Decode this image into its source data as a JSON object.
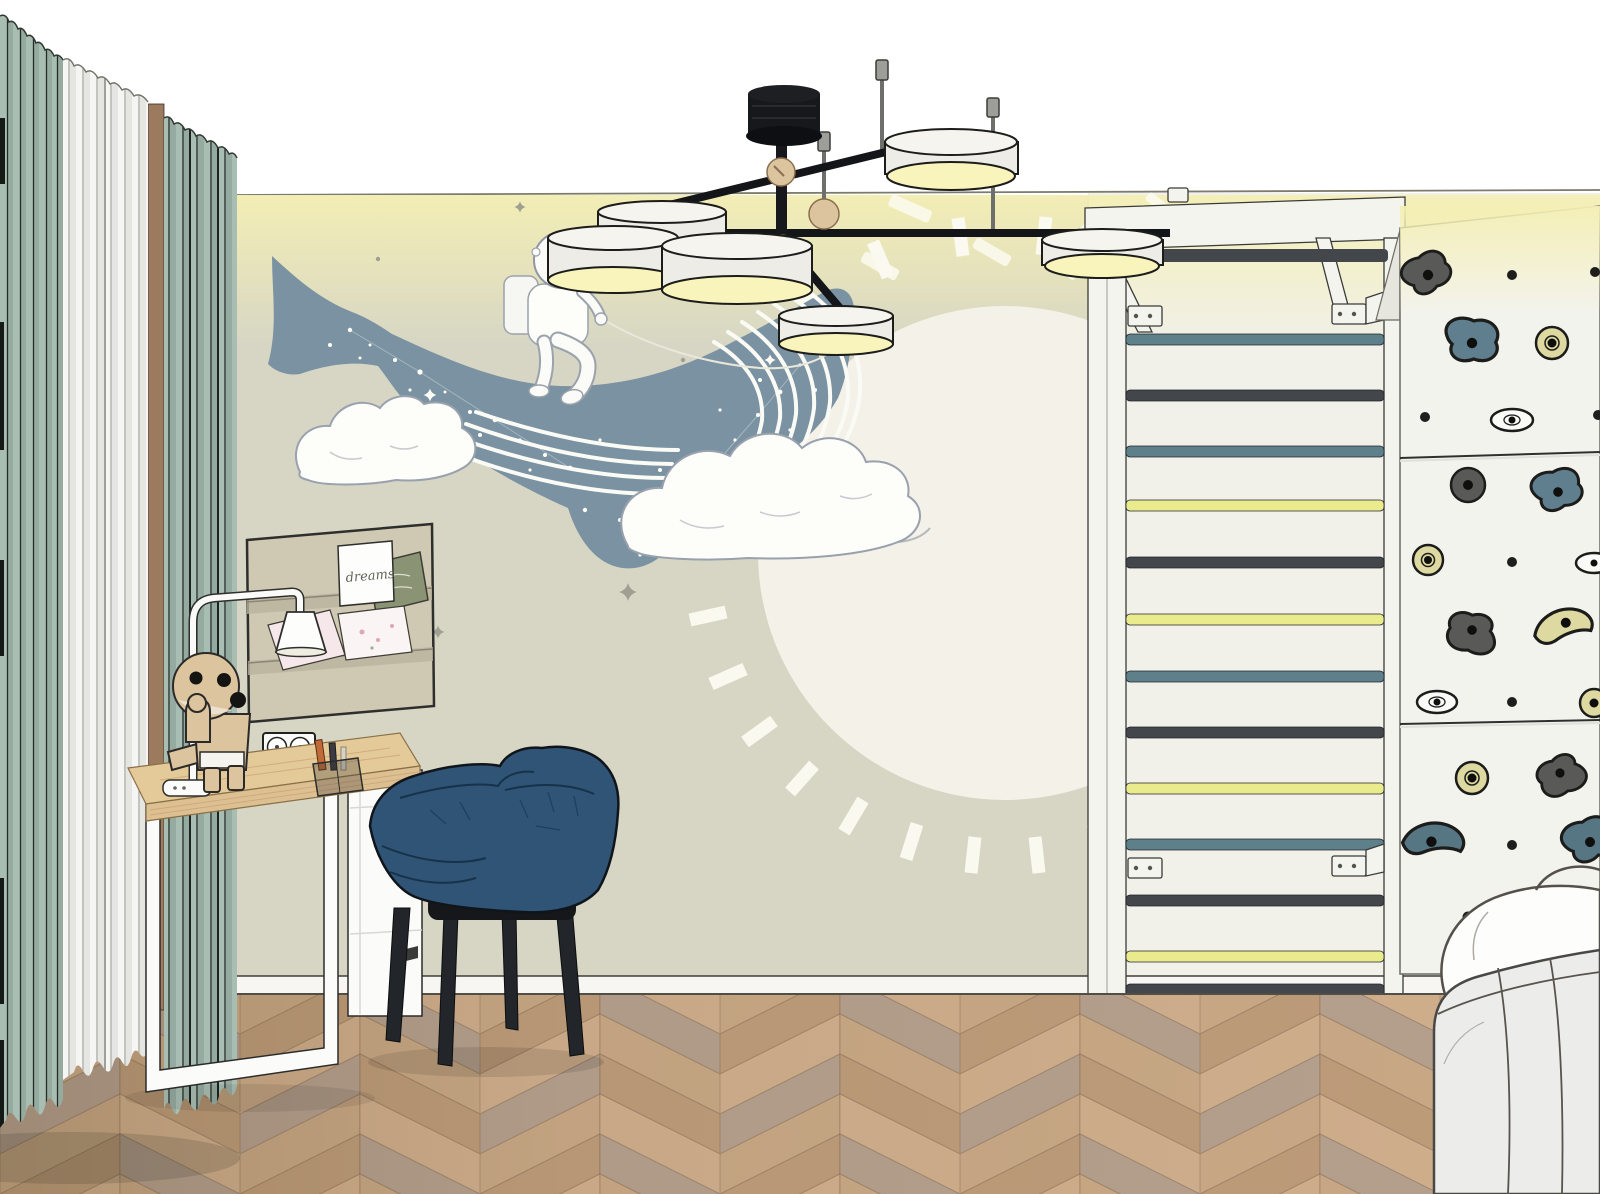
{
  "meta": {
    "title": "Children's room interior - 3D sketch render",
    "view": "room corner with mural wall, workspace and sport wall"
  },
  "pinboard": {
    "label": "fabric wall organizer with pockets",
    "card_text": "dreams",
    "pockets": 3
  },
  "mural": {
    "label": "wallpaper mural: astronaut riding a whale through clouds past a full moon",
    "elements": [
      "whale with star speckles",
      "astronaut with reins",
      "clouds",
      "moon disc",
      "clock tick dashes",
      "sparkles"
    ]
  },
  "furniture": {
    "desk": "wood-top desk with white loop leg and white drawer unit",
    "chair": "navy upholstered armchair with black wooden legs",
    "bed": "white upholstered bed corner with pillow",
    "lamp": "white arched desk lamp",
    "toy": "wooden robot figurine",
    "organizer": "pen tray with pens",
    "outlet": "double wall socket"
  },
  "sport_wall": {
    "wall_bars_rungs": [
      "dark",
      "teal",
      "dark",
      "teal",
      "yellow",
      "dark",
      "yellow",
      "teal",
      "dark",
      "yellow",
      "teal",
      "dark",
      "yellow",
      "dark"
    ],
    "climbing_hold_colors": [
      "dark-gray",
      "slate-blue",
      "pale-yellow",
      "white",
      "teal"
    ],
    "climbing_panels": 3
  },
  "lighting": {
    "fixture": "black multi-arm ceiling lamp with six white drum shades and wooden spheres",
    "shade_count": 6,
    "cove": "warm LED glow along ceiling edge"
  },
  "curtains": {
    "panels": [
      "sage green",
      "white sheer",
      "sage green"
    ],
    "window_trim": "brown"
  },
  "floor": "chevron oak parquet",
  "theme": {
    "colors": {
      "wall": "#d7d6c4",
      "wallRight": "#f1f0e9",
      "glow": "#f4efb4",
      "disc": "#f4f1e8",
      "whale": "#7a92a2",
      "cloud": "#fdfdf9",
      "curtainGreen": "#a9beb2",
      "curtainGreenDark": "#96ab9f",
      "curtainWhite": "#f5f5f3",
      "brown": "#9b7a5e",
      "floor1": "#c8a885",
      "floor2": "#bd9c7a",
      "floor3": "#cfae8c",
      "floor4": "#b5a08e",
      "wood": "#dcc49e",
      "deskWood": "#ddc092",
      "frameWhite": "#fbfbf9",
      "navy": "#2f5476",
      "black": "#17181b",
      "shade": "#edece6",
      "shadeGlow": "#f8f4bb",
      "rungDark": "#43474c",
      "rungTeal": "#5e808b",
      "rungYellow": "#e9eb8d",
      "holdDark": "#595957",
      "holdSlate": "#5f7f8e",
      "holdYellow": "#ddd9a0",
      "holdTeal": "#567684",
      "holdWhite": "#fafaf7",
      "panel": "#f3f3ee",
      "ladderWhite": "#f4f4ef",
      "bed": "#ececea",
      "pillow": "#fdfdfb",
      "pinboard": "#cfc9b3",
      "cardGreen": "#8a9474"
    }
  }
}
